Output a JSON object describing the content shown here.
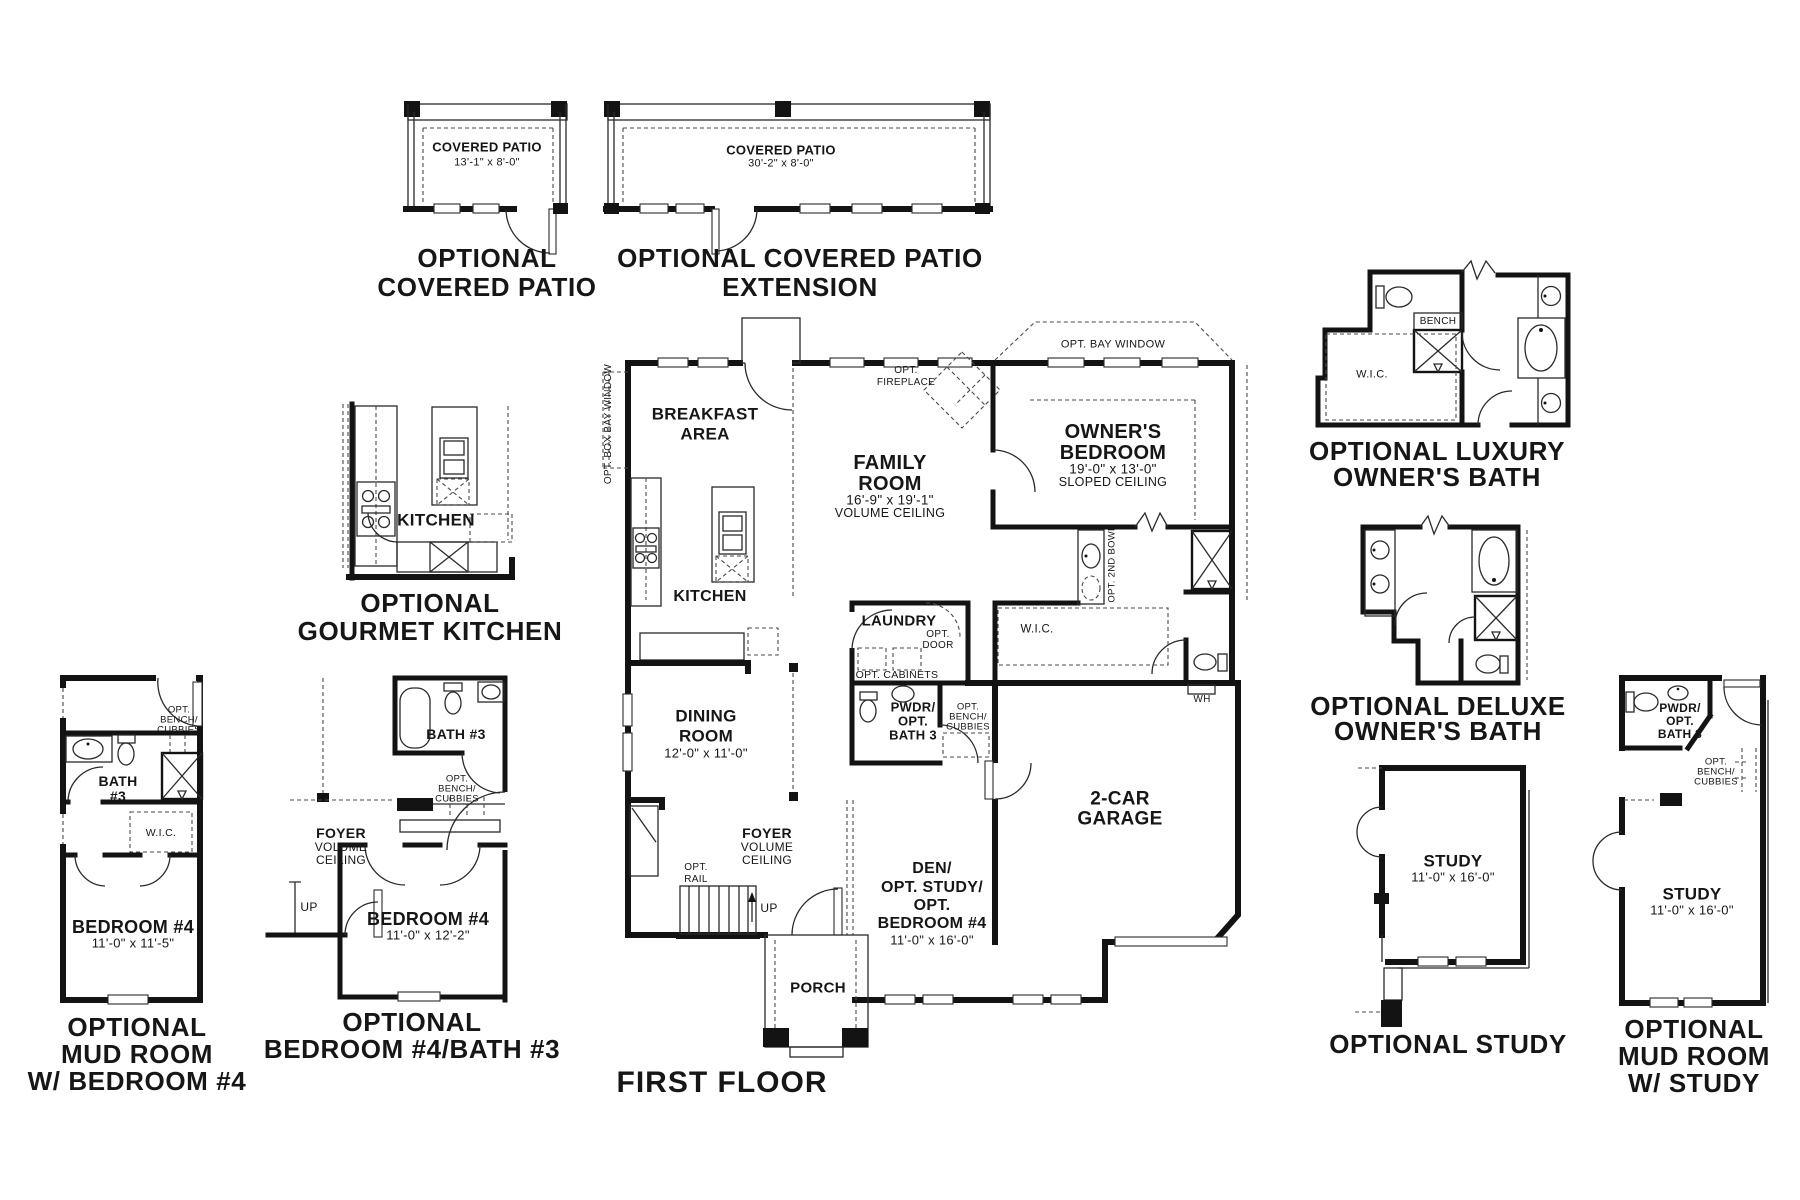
{
  "captions": {
    "patio": [
      "OPTIONAL",
      "COVERED PATIO"
    ],
    "patio_ext": [
      "OPTIONAL COVERED PATIO",
      "EXTENSION"
    ],
    "gourmet": [
      "OPTIONAL",
      "GOURMET KITCHEN"
    ],
    "mud_bed4": [
      "OPTIONAL",
      "MUD ROOM",
      "W/ BEDROOM #4"
    ],
    "bed4_bath3": [
      "OPTIONAL",
      "BEDROOM #4/BATH #3"
    ],
    "luxury": [
      "OPTIONAL LUXURY",
      "OWNER'S BATH"
    ],
    "deluxe": [
      "OPTIONAL DELUXE",
      "OWNER'S BATH"
    ],
    "study": "OPTIONAL STUDY",
    "mud_study": [
      "OPTIONAL",
      "MUD ROOM",
      "W/ STUDY"
    ],
    "first_floor": "FIRST FLOOR"
  },
  "patio": {
    "room": "COVERED PATIO",
    "dim": "13'-1\" x 8'-0\""
  },
  "patio_ext": {
    "room": "COVERED PATIO",
    "dim": "30'-2\" x 8'-0\""
  },
  "gourmet": {
    "room": "KITCHEN"
  },
  "mud_bed4": {
    "bench": [
      "OPT.",
      "BENCH/",
      "CUBBIES"
    ],
    "bath": [
      "BATH",
      "#3"
    ],
    "wic": "W.I.C.",
    "room": "BEDROOM #4",
    "dim": "11'-0\" x 11'-5\""
  },
  "bed4_bath3": {
    "bath": "BATH #3",
    "bench": [
      "OPT.",
      "BENCH/",
      "CUBBIES"
    ],
    "foyer": [
      "FOYER",
      "VOLUME",
      "CEILING"
    ],
    "up": "UP",
    "room": "BEDROOM #4",
    "dim": "11'-0\" x 12'-2\""
  },
  "main": {
    "box_bay": "OPT. BOX BAY WINDOW",
    "breakfast": [
      "BREAKFAST",
      "AREA"
    ],
    "family": [
      "FAMILY",
      "ROOM"
    ],
    "family_dim": "16'-9\" x 19'-1\"",
    "family_note": "VOLUME CEILING",
    "fireplace": [
      "OPT.",
      "FIREPLACE"
    ],
    "bay_window": "OPT. BAY WINDOW",
    "owner": [
      "OWNER'S",
      "BEDROOM"
    ],
    "owner_dim": "19'-0\" x 13'-0\"",
    "owner_note": "SLOPED CEILING",
    "kitchen": "KITCHEN",
    "laundry": "LAUNDRY",
    "opt_door": [
      "OPT.",
      "DOOR"
    ],
    "opt_cabinets": "OPT. CABINETS",
    "wic": "W.I.C.",
    "second_bowl": "OPT. 2ND BOWL",
    "dining": [
      "DINING",
      "ROOM"
    ],
    "dining_dim": "12'-0\" x 11'-0\"",
    "pwdr": [
      "PWDR/",
      "OPT.",
      "BATH 3"
    ],
    "bench": [
      "OPT.",
      "BENCH/",
      "CUBBIES"
    ],
    "wh": "WH",
    "garage": [
      "2-CAR",
      "GARAGE"
    ],
    "foyer": [
      "FOYER",
      "VOLUME",
      "CEILING"
    ],
    "opt_rail": [
      "OPT.",
      "RAIL"
    ],
    "up": "UP",
    "den": [
      "DEN/",
      "OPT. STUDY/",
      "OPT.",
      "BEDROOM #4"
    ],
    "den_dim": "11'-0\" x 16'-0\"",
    "porch": "PORCH"
  },
  "luxury": {
    "bench": "BENCH",
    "wic": "W.I.C."
  },
  "study": {
    "room": "STUDY",
    "dim": "11'-0\" x 16'-0\""
  },
  "mud_study": {
    "pwdr": [
      "PWDR/",
      "OPT.",
      "BATH 3"
    ],
    "bench": [
      "OPT.",
      "BENCH/",
      "CUBBIES"
    ],
    "room": "STUDY",
    "dim": "11'-0\" x 16'-0\""
  }
}
